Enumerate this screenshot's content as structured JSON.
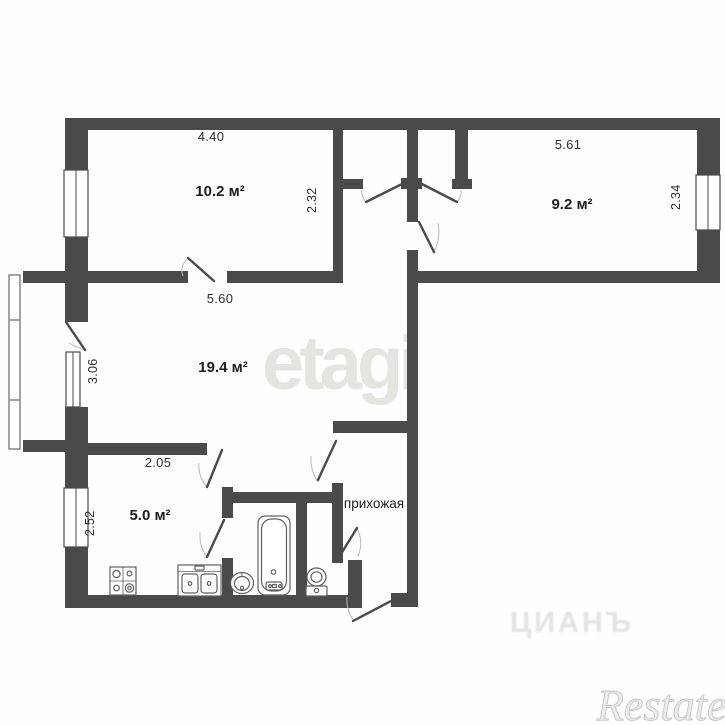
{
  "plan": {
    "type": "apartment-floor-plan",
    "rooms": [
      {
        "name": "room-10-2",
        "area_label": "10.2 м²"
      },
      {
        "name": "room-9-2",
        "area_label": "9.2 м²"
      },
      {
        "name": "room-19-4",
        "area_label": "19.4 м²"
      },
      {
        "name": "kitchen",
        "area_label": "5.0 м²"
      },
      {
        "name": "hallway",
        "label": "прихожая"
      }
    ],
    "dimensions": {
      "room_10_2_width": "4.40",
      "room_10_2_depth": "2.32",
      "room_9_2_width": "5.61",
      "room_9_2_depth": "2.34",
      "room_19_4_width": "5.60",
      "room_19_4_left": "3.06",
      "kitchen_width": "2.05",
      "kitchen_left": "2.52"
    },
    "watermarks": {
      "center": "etagi",
      "portal": "ЦИАНЪ",
      "agency": "Restate"
    },
    "icons": [
      "stove-icon",
      "kitchen-sink-icon",
      "washbasin-icon",
      "bathtub-icon",
      "toilet-icon",
      "window-icon",
      "balcony-icon",
      "door-leaf"
    ],
    "colors": {
      "wall": "#4a4a48",
      "fixture_stroke": "#606060",
      "door_arc": "#b8b8b6",
      "dimension_text": "#2e2e2e",
      "area_text": "#1d1d1b",
      "watermark_center": "#e4e4e0"
    }
  }
}
